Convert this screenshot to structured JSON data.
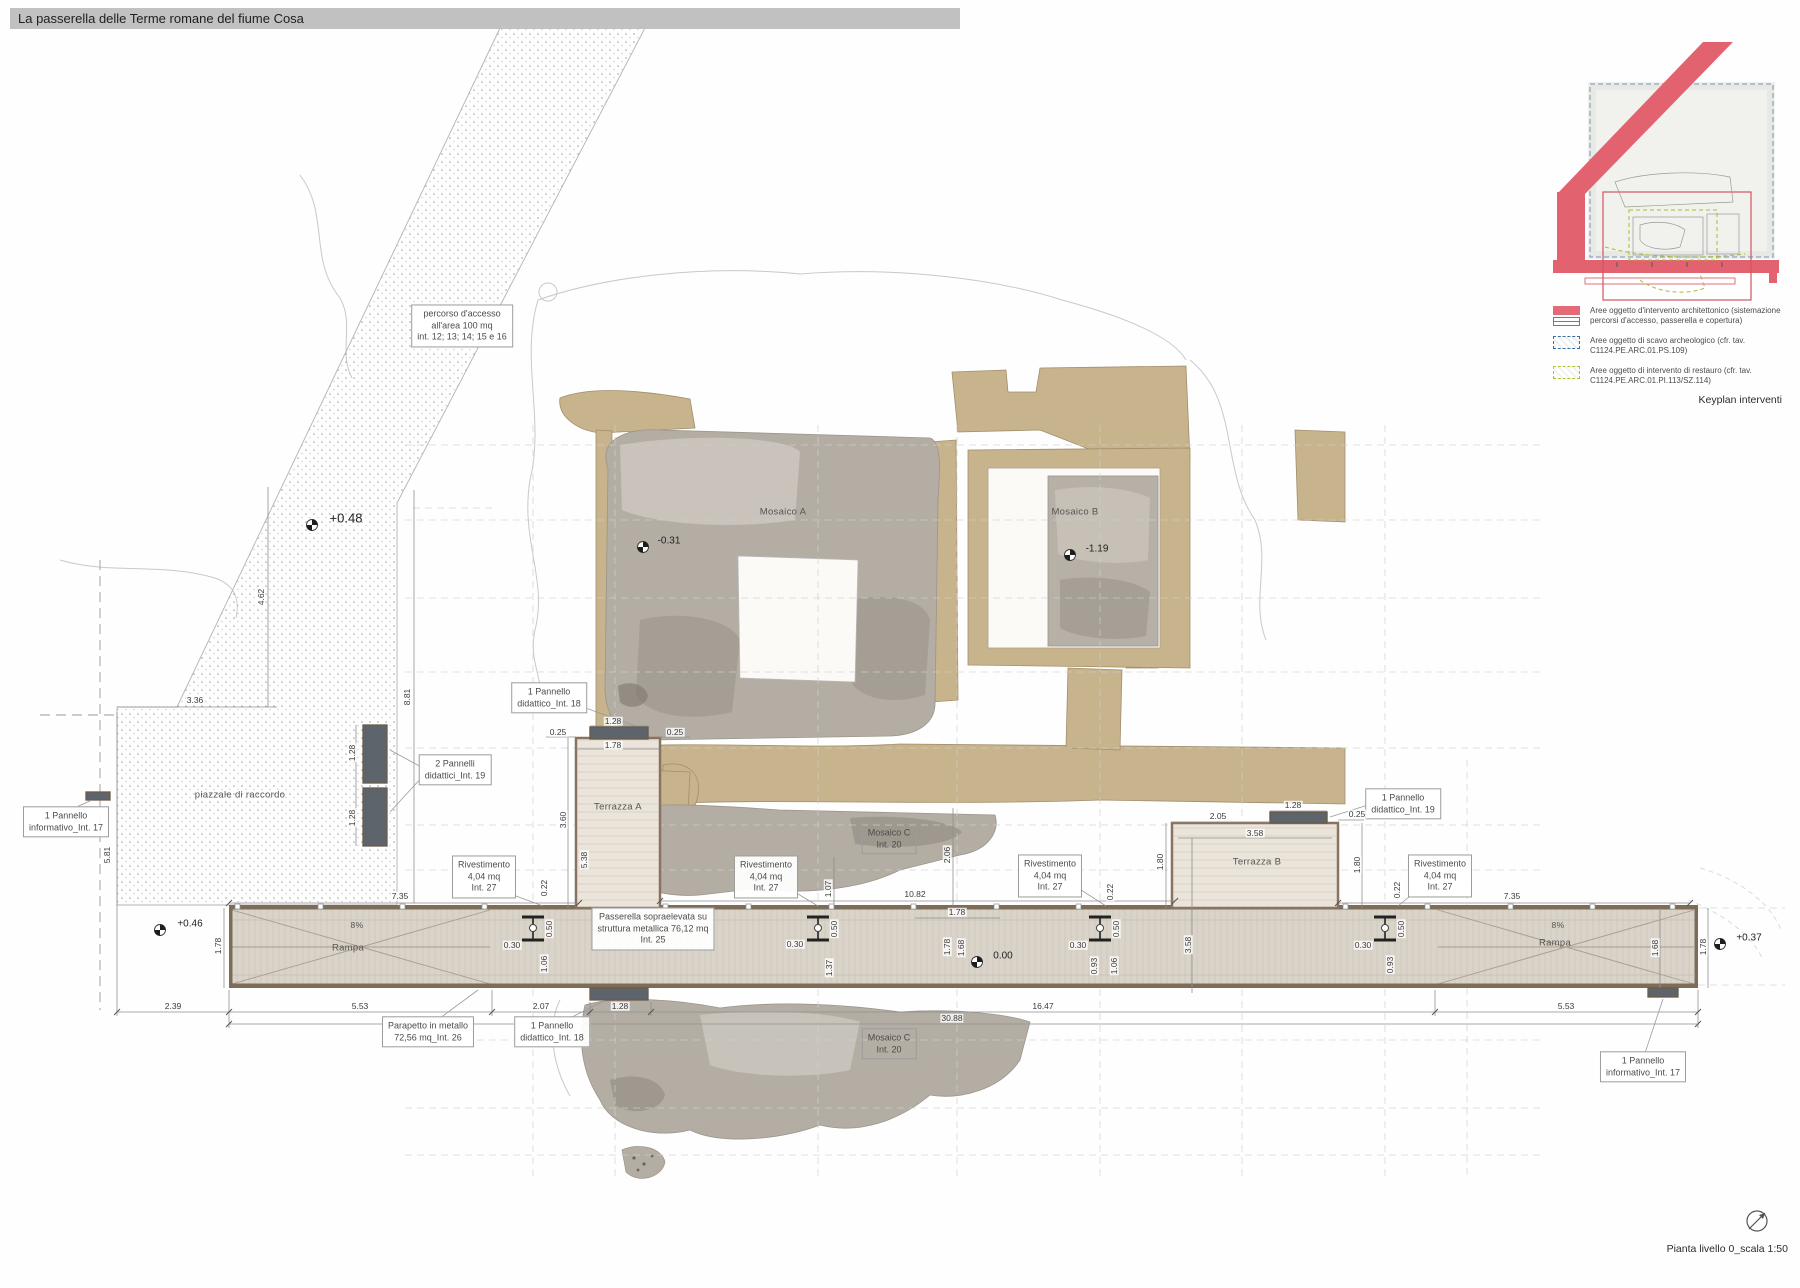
{
  "title": "La passerella delle Terme romane del fiume Cosa",
  "keyplan": {
    "caption": "Keyplan interventi",
    "legend": [
      {
        "label": "Aree oggetto d'intervento architettonico (sistemazione percorsi d'accesso, passerella e copertura)",
        "color": "#e26b76"
      },
      {
        "label": "Aree oggetto di scavo archeologico (cfr. tav. C1124.PE.ARC.01.PS.109)",
        "color": "#3a6ea8"
      },
      {
        "label": "Aree oggetto di intervento di restauro (cfr. tav. C1124.PE.ARC.01.PI.113/SZ.114)",
        "color": "#b4bf3c"
      }
    ]
  },
  "labels": {
    "percorso": "percorso d'accesso\nall'area 100 mq\nint. 12; 13; 14; 15 e 16",
    "pannello_info_17": "1 Pannello\ninformativo_Int. 17",
    "pannelli_didattici_19": "2 Pannelli\ndidattici_Int. 19",
    "pannello_didattico_18": "1 Pannello\ndidattico_Int. 18",
    "pannello_didattico_19": "1 Pannello\ndidattico_Int. 19",
    "rivestimento_27": "Rivestimento\n4,04 mq\nInt. 27",
    "passerella_25": "Passerella sopraelevata su\nstruttura metallica 76,12 mq\nInt. 25",
    "parapetto_26": "Parapetto in metallo\n72,56 mq_Int. 26",
    "mosaico_c_20": "Mosaico C\nInt. 20",
    "piazzale": "piazzale di raccordo",
    "terrazza_a": "Terrazza A",
    "terrazza_b": "Terrazza B",
    "mosaico_a": "Mosaico A",
    "mosaico_b": "Mosaico B",
    "rampa": "Rampa",
    "pendenza": "8%"
  },
  "levels": {
    "p048": "+0.48",
    "p046": "+0.46",
    "p037": "+0.37",
    "zero": "0.00",
    "m031": "-0.31",
    "m119": "-1.19"
  },
  "dims": {
    "v336": "3.36",
    "v462": "4.62",
    "v881": "8.81",
    "v581": "5.81",
    "v128": "1.28",
    "v025": "0.25",
    "v178": "1.78",
    "v360": "3.60",
    "v538": "5.38",
    "v022": "0.22",
    "v735": "7.35",
    "v1082": "10.82",
    "v206": "2.06",
    "v205": "2.05",
    "v358": "3.58",
    "v180": "1.80",
    "v239": "2.39",
    "v553": "5.53",
    "v207": "2.07",
    "v1647": "16.47",
    "v3088": "30.88",
    "v050": "0.50",
    "v030": "0.30",
    "v106": "1.06",
    "v093": "0.93",
    "v137": "1.37",
    "v168": "1.68",
    "v107": "1.07"
  },
  "footer": {
    "caption": "Pianta livello 0_scala 1:50"
  }
}
